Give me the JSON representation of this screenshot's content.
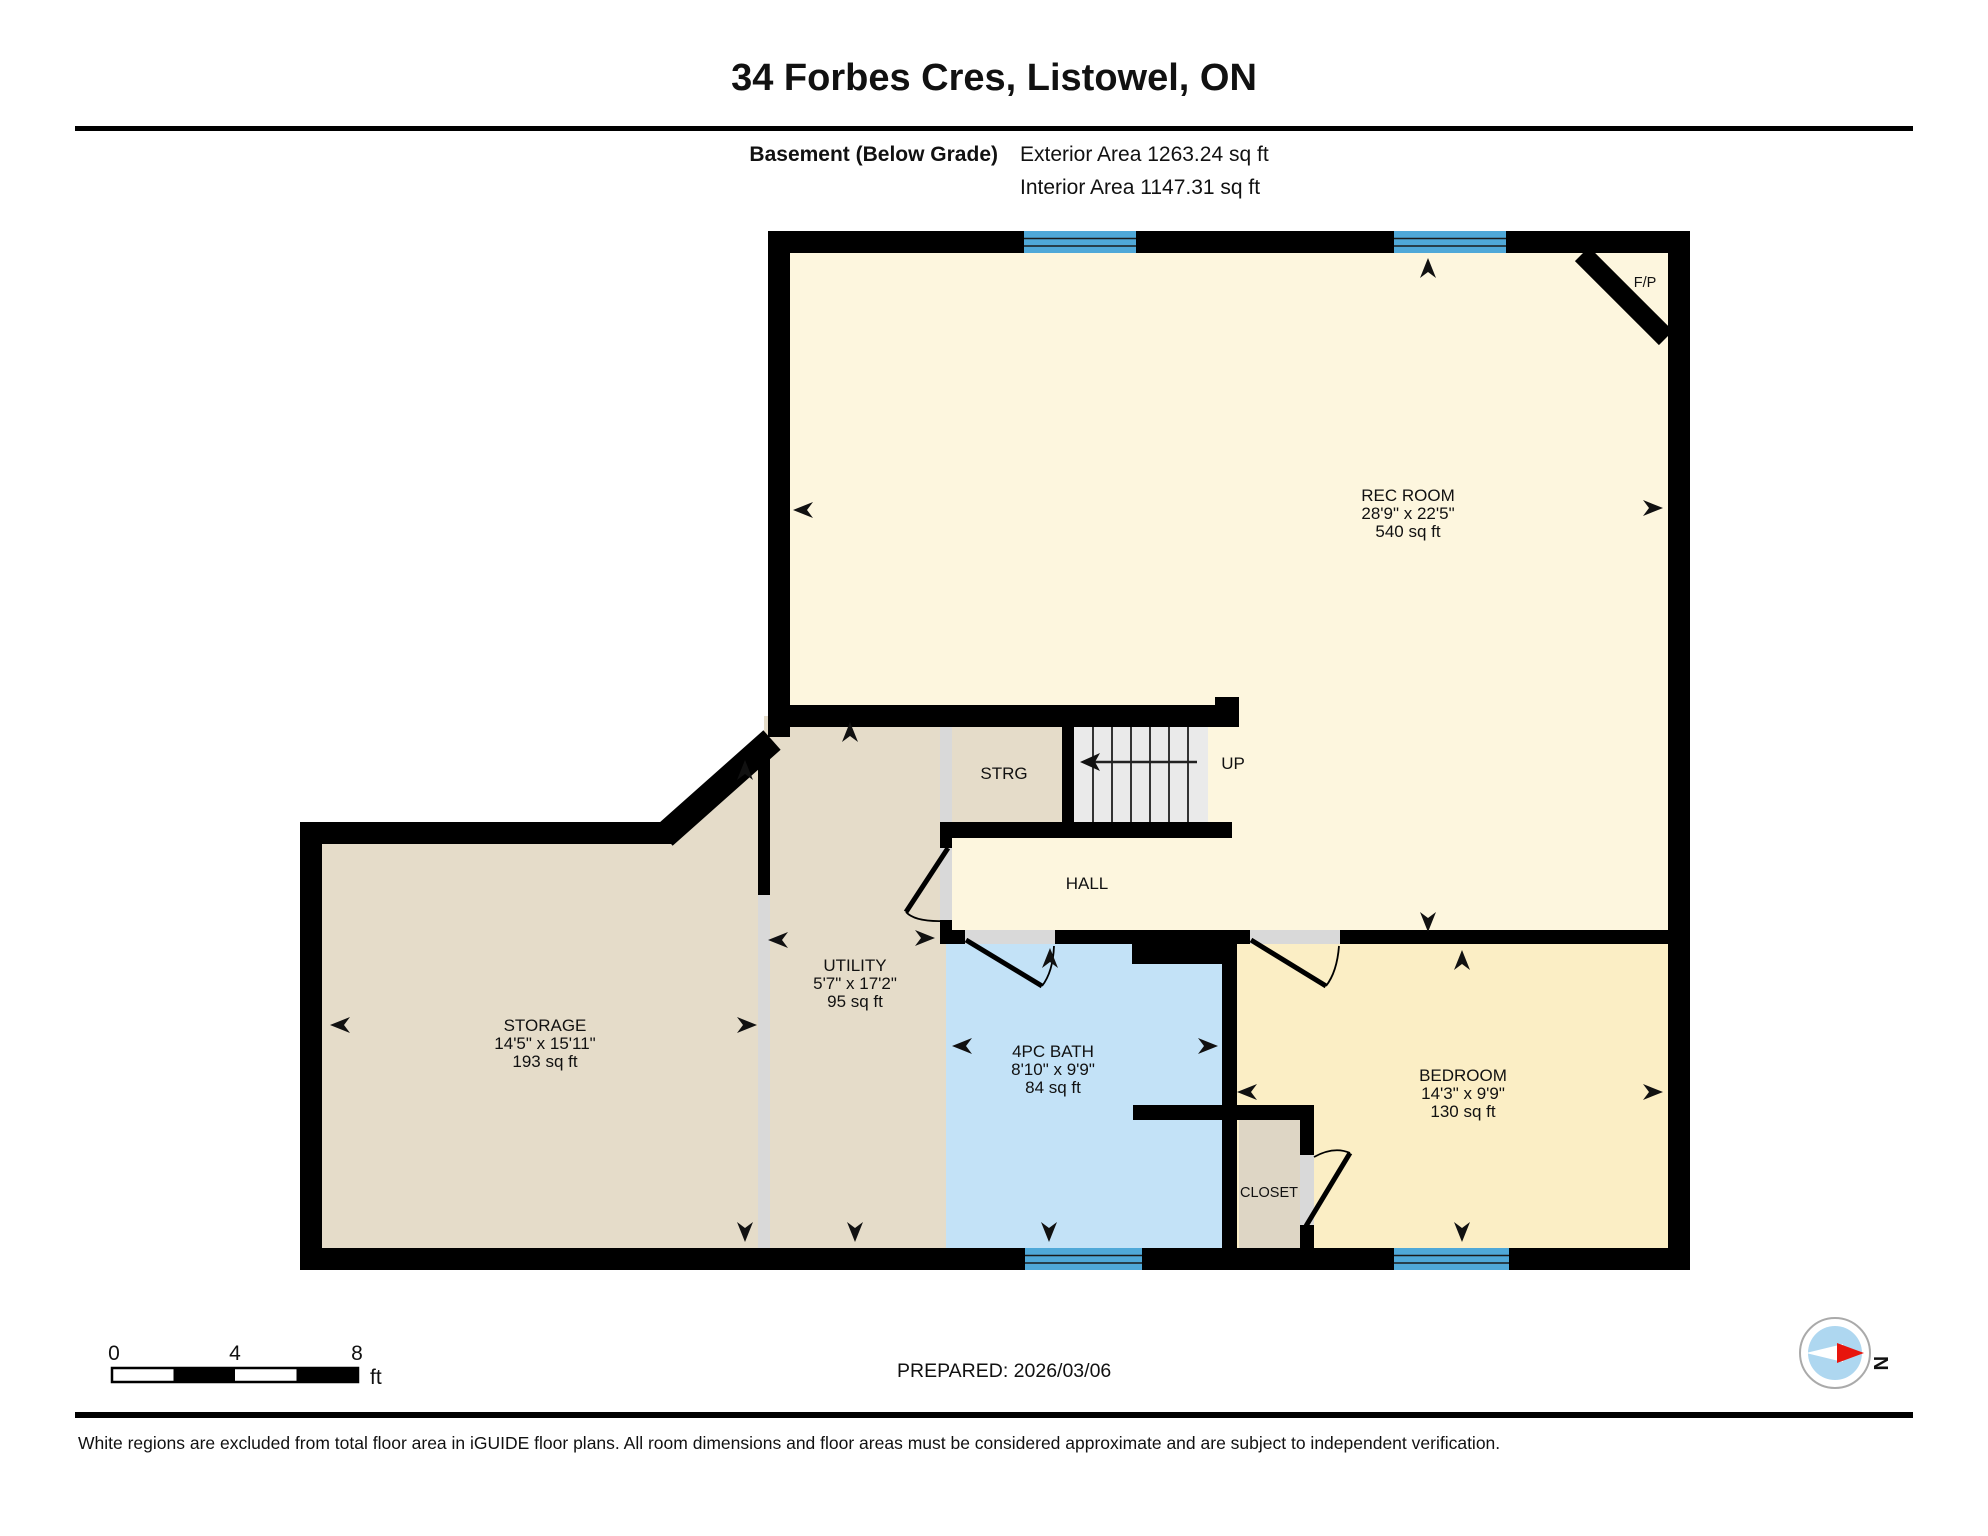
{
  "header": {
    "title": "34 Forbes Cres, Listowel, ON",
    "floor_label": "Basement (Below Grade)",
    "exterior_area": "Exterior Area 1263.24 sq ft",
    "interior_area": "Interior Area 1147.31 sq ft"
  },
  "rooms": {
    "rec_room": {
      "name": "REC ROOM",
      "dimensions": "28'9\" x 22'5\"",
      "area": "540 sq ft"
    },
    "storage": {
      "name": "STORAGE",
      "dimensions": "14'5\" x 15'11\"",
      "area": "193 sq ft"
    },
    "utility": {
      "name": "UTILITY",
      "dimensions": "5'7\" x 17'2\"",
      "area": "95 sq ft"
    },
    "bath": {
      "name": "4PC BATH",
      "dimensions": "8'10\" x 9'9\"",
      "area": "84 sq ft"
    },
    "bedroom": {
      "name": "BEDROOM",
      "dimensions": "14'3\" x 9'9\"",
      "area": "130 sq ft"
    },
    "strg": {
      "name": "STRG"
    },
    "hall": {
      "name": "HALL"
    },
    "closet": {
      "name": "CLOSET"
    },
    "stairs": {
      "label": "UP"
    },
    "fireplace": {
      "label": "F/P"
    }
  },
  "scale_bar": {
    "ticks": [
      "0",
      "4",
      "8"
    ],
    "unit": "ft"
  },
  "compass": {
    "north_label": "N"
  },
  "footer": {
    "prepared": "PREPARED: 2026/03/06",
    "disclaimer": "White regions are excluded from total floor area in iGUIDE floor plans. All room dimensions and floor areas must be considered approximate and are subject to independent verification."
  },
  "colors": {
    "rec_room_fill": "#FDF6DE",
    "tan_fill": "#E5DCC9",
    "closet_fill": "#DED6C5",
    "bedroom_fill": "#FBEEC5",
    "bath_fill": "#C3E2F7",
    "stairs_fill": "#EAEAEA",
    "window_blue": "#4FA8D8",
    "wall_black": "#000000",
    "opening_gray": "#D9D9D9",
    "compass_blue": "#AED7F0",
    "compass_red": "#E8150D"
  }
}
